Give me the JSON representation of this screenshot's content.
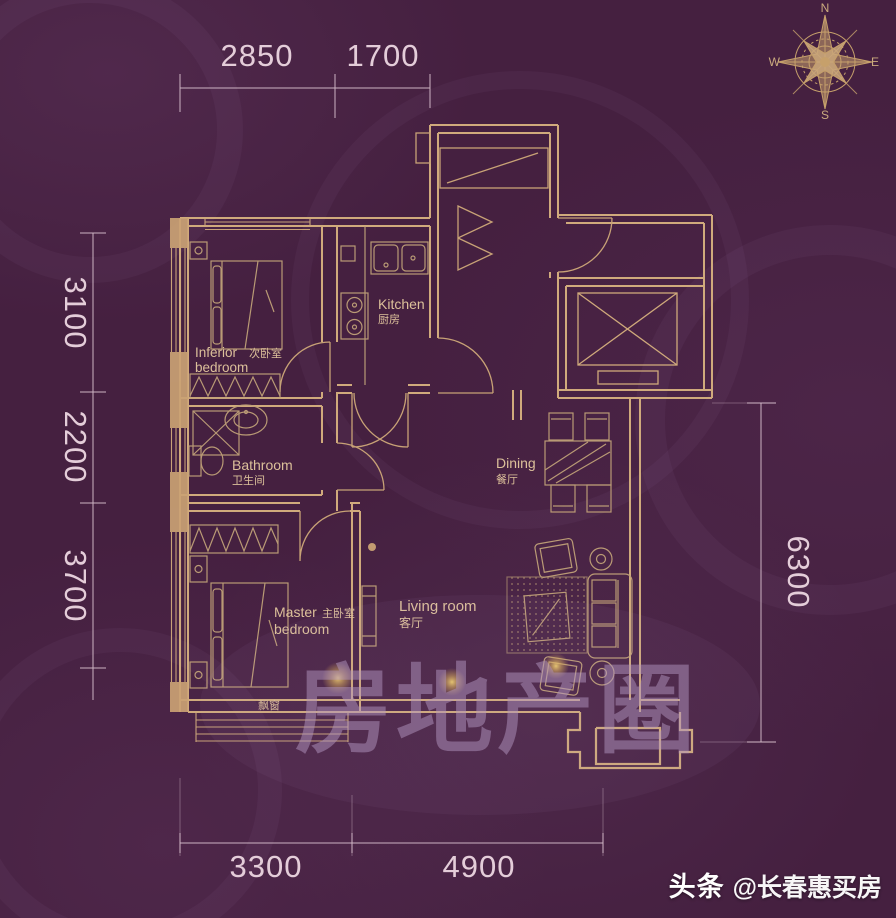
{
  "meta": {
    "type": "apartment-floor-plan"
  },
  "colors": {
    "background": "#452040",
    "walls": "#d0aa7c",
    "furniture": "#c0a178",
    "dimensions": "#e4cdd9",
    "labels": "#dcc09a",
    "watermark": "#b295c0",
    "badge_text": "#ffffff",
    "gold_blob": "#e8c56b"
  },
  "compass": {
    "north": "N",
    "south": "S",
    "east": "E",
    "west": "W"
  },
  "dims": {
    "top": [
      "2850",
      "1700"
    ],
    "left": [
      "3100",
      "2200",
      "3700"
    ],
    "right": [
      "6300"
    ],
    "bottom": [
      "3300",
      "4900"
    ]
  },
  "rooms": {
    "kitchen": {
      "en": "Kitchen",
      "zh": "厨房"
    },
    "bathroom": {
      "en": "Bathroom",
      "zh": "卫生间"
    },
    "dining": {
      "en": "Dining",
      "zh": "餐厅"
    },
    "living": {
      "en": "Living room",
      "zh": "客厅"
    },
    "secondary": {
      "en1": "Inferior",
      "zh": "次卧室",
      "en2": "bedroom"
    },
    "master": {
      "en1": "Master",
      "zh": "主卧室",
      "en2": "bedroom"
    },
    "bay_window": "飘窗"
  },
  "watermark": {
    "center": "房地产圈",
    "brand": "头条",
    "handle": "@长春惠买房"
  }
}
